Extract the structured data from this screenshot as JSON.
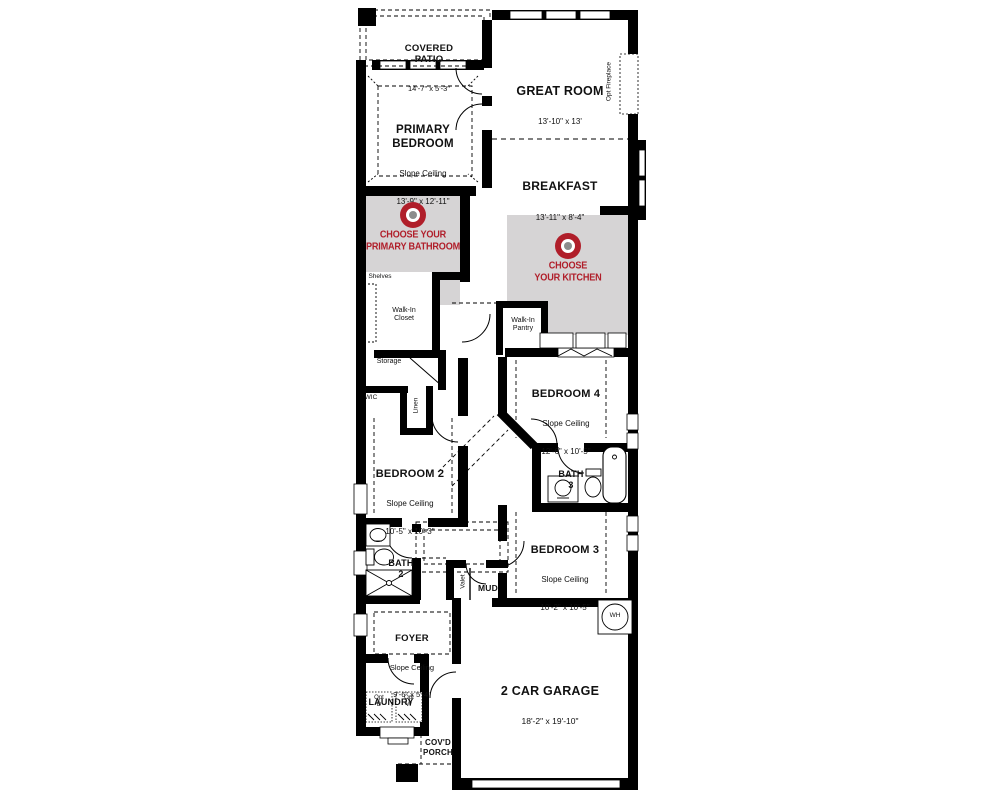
{
  "colors": {
    "accent": "#b01e2a",
    "zone": "#d6d4d5",
    "ink": "#111111"
  },
  "badges": {
    "bathroom": "CHOOSE YOUR\nPRIMARY BATHROOM",
    "kitchen": "CHOOSE\nYOUR KITCHEN"
  },
  "rooms": {
    "covered_patio": {
      "name": "COVERED\nPATIO",
      "dims": "14'-7\" x 5'-3\""
    },
    "great_room": {
      "name": "GREAT ROOM",
      "dims": "13'-10\" x 13'"
    },
    "primary_bedroom": {
      "name": "PRIMARY\nBEDROOM",
      "sub": "Slope Ceiling",
      "dims": "13'-9\" x 12'-11\""
    },
    "breakfast": {
      "name": "BREAKFAST",
      "dims": "13'-11\" x 8'-4\""
    },
    "bedroom4": {
      "name": "BEDROOM 4",
      "sub": "Slope Ceiling",
      "dims": "12'-6\" x 10'-5\""
    },
    "bedroom2": {
      "name": "BEDROOM 2",
      "sub": "Slope Ceiling",
      "dims": "10'-5\" x 10'-3\""
    },
    "bedroom3": {
      "name": "BEDROOM 3",
      "sub": "Slope Ceiling",
      "dims": "10'-2\" x 10'-5\""
    },
    "bath2": {
      "name": "BATH\n2"
    },
    "bath3": {
      "name": "BATH\n3"
    },
    "foyer": {
      "name": "FOYER",
      "sub": "Slope Ceiling",
      "dims": "9'-6\" x 5'-4\""
    },
    "laundry": {
      "name": "LAUNDRY"
    },
    "mud": {
      "name": "MUD"
    },
    "garage": {
      "name": "2 CAR GARAGE",
      "dims": "18'-2\" x 19'-10\""
    },
    "covd_porch": {
      "name": "COV'D\nPORCH"
    }
  },
  "annotations": {
    "opt_fireplace": "Opt Fireplace",
    "shelves": "Shelves",
    "walk_in_closet": "Walk-In\nCloset",
    "walk_in_pantry": "Walk-In\nPantry",
    "storage": "Storage",
    "wic": "WIC",
    "linen": "Linen",
    "valet": "Valet",
    "wh": "WH",
    "opt_d": "Opt\nD",
    "opt_w": "Opt\nW"
  }
}
